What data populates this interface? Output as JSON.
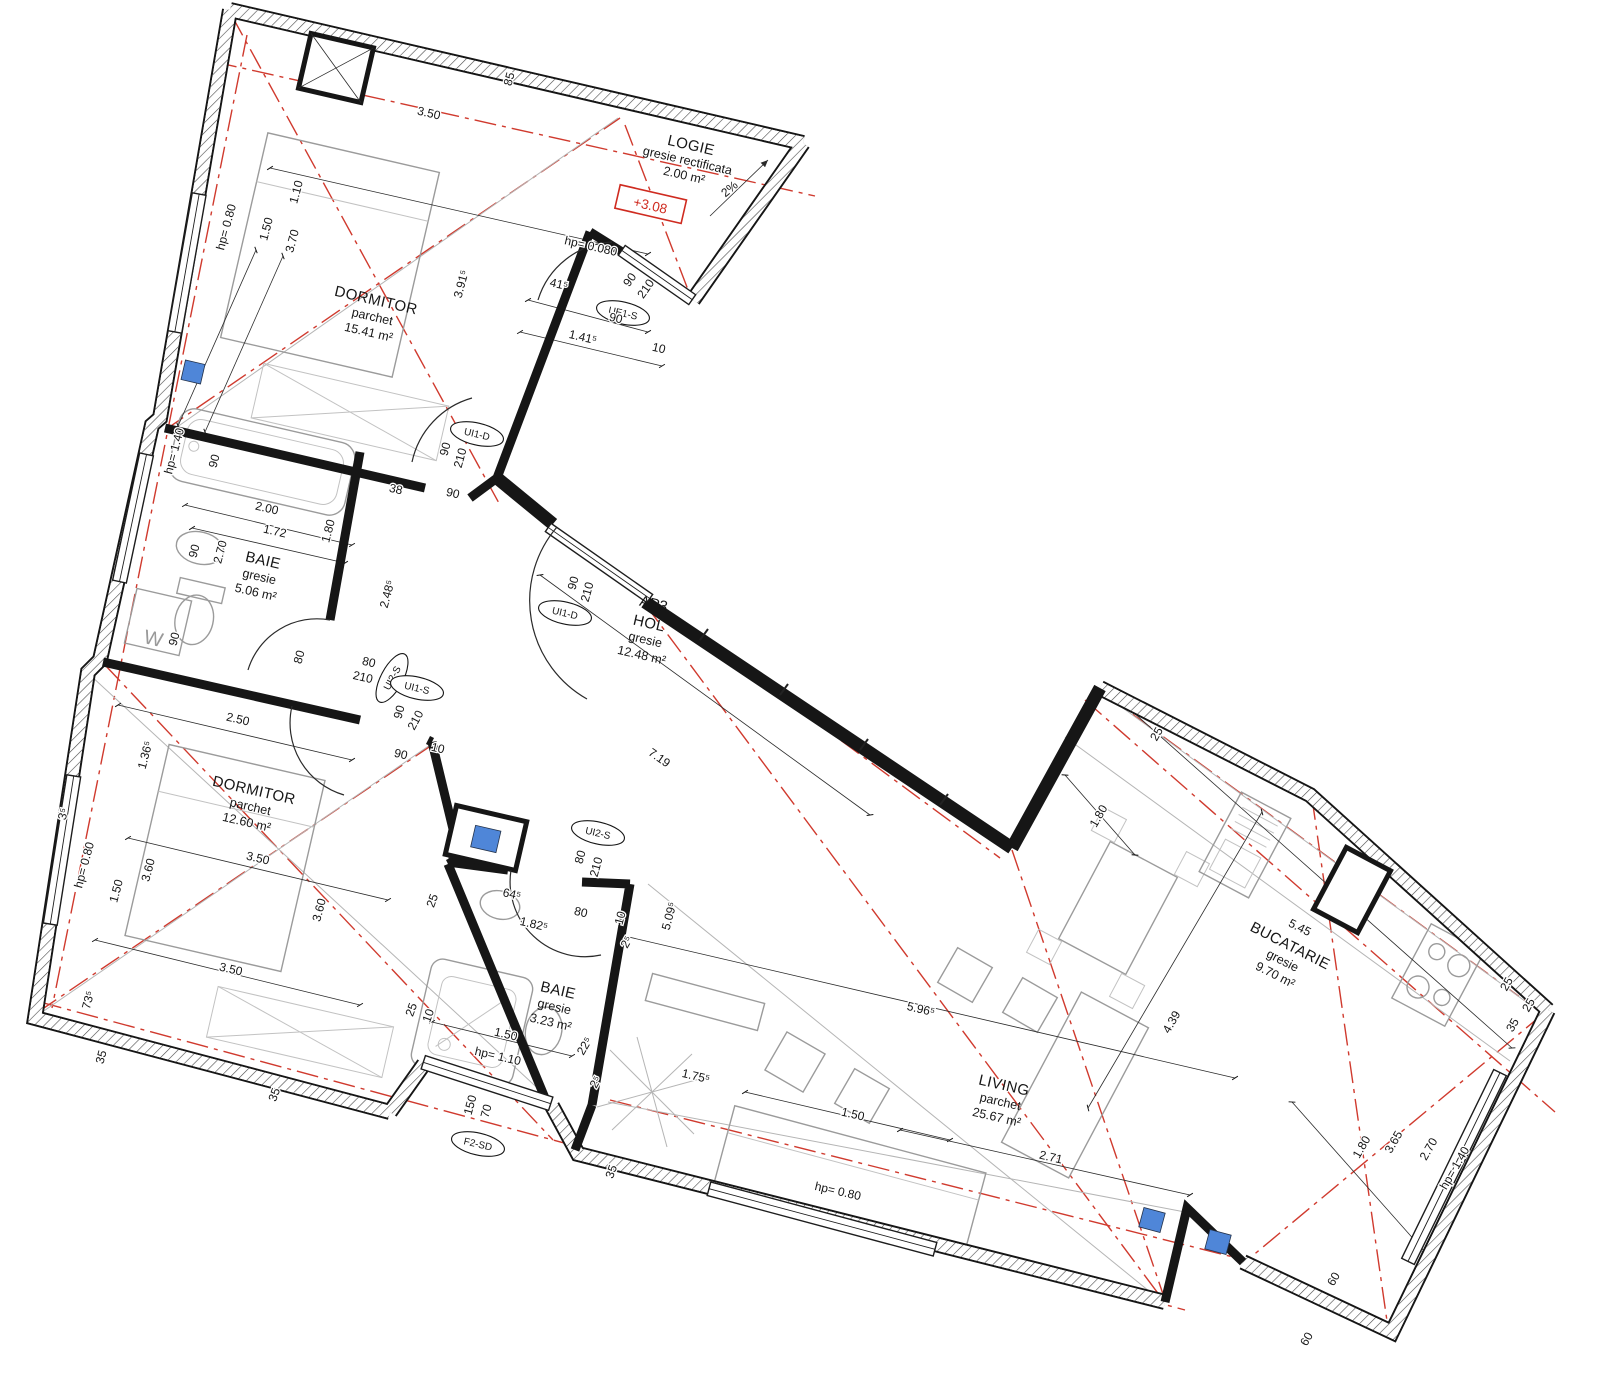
{
  "drawing_type": "apartment floor plan",
  "apartment": {
    "code": "AP3"
  },
  "level": {
    "value": "+3.08"
  },
  "slope": {
    "label": "2%"
  },
  "laundry_label": "W",
  "colors": {
    "wall": "#161616",
    "axis_red": "#d03a2e",
    "marker_red": "#cf2b20",
    "furniture_gray": "#9b9b9b",
    "column_blue": "#4f86d8",
    "background": "#ffffff"
  },
  "rooms": [
    {
      "name": "LOGIE",
      "finish": "gresie rectificata",
      "area": "2.00 m²"
    },
    {
      "name": "DORMITOR",
      "finish": "parchet",
      "area": "15.41 m²"
    },
    {
      "name": "BAIE",
      "finish": "gresie",
      "area": "5.06 m²"
    },
    {
      "name": "HOL",
      "finish": "gresie",
      "area": "12.48 m²"
    },
    {
      "name": "DORMITOR",
      "finish": "parchet",
      "area": "12.60 m²"
    },
    {
      "name": "BAIE",
      "finish": "gresie",
      "area": "3.23 m²"
    },
    {
      "name": "LIVING",
      "finish": "parchet",
      "area": "25.67 m²"
    },
    {
      "name": "BUCATARIE",
      "finish": "gresie",
      "area": "9.70 m²"
    }
  ],
  "openings": [
    {
      "code": "UE1-S"
    },
    {
      "code": "UI1-D"
    },
    {
      "code": "UI1-D"
    },
    {
      "code": "UI2-S"
    },
    {
      "code": "UI1-S"
    },
    {
      "code": "UI2-S"
    },
    {
      "code": "F2-SD"
    }
  ],
  "dims": [
    "1.10",
    "3.50",
    "hp= 0.80",
    "1.50",
    "3.70",
    "85",
    "3.91⁵",
    "hp= 0.080",
    "41⁵",
    "90",
    "1.41⁵",
    "90",
    "210",
    "10",
    "90",
    "210",
    "38",
    "90",
    "hp= 1.40",
    "90",
    "2.00",
    "1.72",
    "1.80",
    "2.70",
    "90",
    "90",
    "2.48⁵",
    "80",
    "80",
    "210",
    "90",
    "210",
    "90",
    "210",
    "2.50",
    "1.36⁵",
    "90",
    "10",
    "hp= 0.80",
    "1.50",
    "3.60",
    "3.50",
    "3.60",
    "3⁵",
    "73⁵",
    "35",
    "3.50",
    "35",
    "25",
    "64⁵",
    "80",
    "10",
    "1.82⁵",
    "2⁵",
    "80",
    "210",
    "5.09⁵",
    "25",
    "10",
    "1.50",
    "hp= 1.10",
    "22⁵",
    "2⁵",
    "150",
    "70",
    "1.75⁵",
    "1.50",
    "hp= 0.80",
    "35",
    "5.96⁵",
    "7.19",
    "4.39",
    "5.45",
    "2.71",
    "1.80",
    "25",
    "25",
    "25",
    "35",
    "1.80",
    "3.65",
    "2.70",
    "hp= 1.40",
    "60",
    "60"
  ]
}
